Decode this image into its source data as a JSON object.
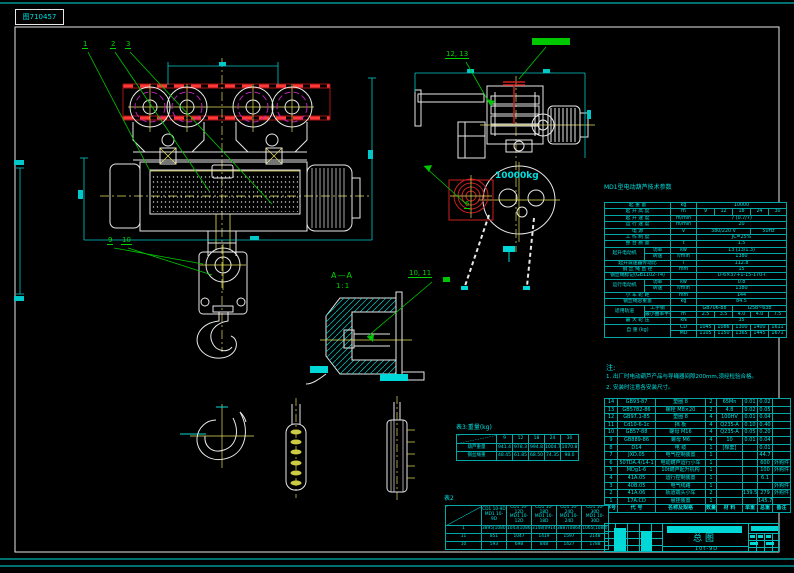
{
  "stamp": {
    "text": "图710457"
  },
  "annotations": {
    "c1": "1",
    "c2": "2",
    "c3": "3",
    "c6": "6",
    "c9": "9",
    "c10": "10",
    "c10_11": "10, 11",
    "c12_13": "12, 13",
    "section": "A—A",
    "scale": "1:1",
    "load": "10000kg"
  },
  "spec_table": {
    "title": "MD1型电动葫芦技术参数",
    "colw": [
      40,
      26,
      26,
      18,
      18,
      18,
      18,
      18
    ],
    "rows": [
      [
        {
          "t": "起 重 量",
          "c": 2
        },
        {
          "t": "kg"
        },
        {
          "t": "10000",
          "c": 5
        }
      ],
      [
        {
          "t": "起 升 高 度",
          "c": 2
        },
        {
          "t": "m"
        },
        {
          "t": "9"
        },
        {
          "t": "12"
        },
        {
          "t": "18"
        },
        {
          "t": "24"
        },
        {
          "t": "30"
        }
      ],
      [
        {
          "t": "起 升 速 度",
          "c": 2
        },
        {
          "t": "m/min"
        },
        {
          "t": "7 (0.7/7)",
          "c": 5
        }
      ],
      [
        {
          "t": "运 行 速 度",
          "c": 2
        },
        {
          "t": "m/min"
        },
        {
          "t": "20",
          "c": 5
        }
      ],
      [
        {
          "t": "电  源",
          "c": 2
        },
        {
          "t": "V"
        },
        {
          "t": "380/220 V",
          "c": 3
        },
        {
          "t": "50Hz",
          "c": 2
        }
      ],
      [
        {
          "t": "工 作 制 度",
          "c": 2
        },
        {
          "t": ""
        },
        {
          "t": "JC=25%",
          "c": 5
        }
      ],
      [
        {
          "t": "整 台 质 量",
          "c": 2
        },
        {
          "t": "t"
        },
        {
          "t": "1.5",
          "c": 5
        }
      ],
      [
        {
          "t": "起升电动机",
          "r": 2
        },
        {
          "t": "功率"
        },
        {
          "t": "kw"
        },
        {
          "t": "13 (13/1.3)",
          "c": 5
        }
      ],
      [
        {
          "t": "转速"
        },
        {
          "t": "r/min"
        },
        {
          "t": "1380",
          "c": 5
        }
      ],
      [
        {
          "t": "起升减速器传动比",
          "c": 2
        },
        {
          "t": "i"
        },
        {
          "t": "112.8",
          "c": 5
        }
      ],
      [
        {
          "t": "钢 丝 绳 直 径",
          "c": 2
        },
        {
          "t": "mm"
        },
        {
          "t": "15",
          "c": 5
        }
      ],
      [
        {
          "t": "钢丝绳标记(GB1102-74)",
          "c": 2
        },
        {
          "t": ""
        },
        {
          "t": "D-6×37+1-15-170-I",
          "c": 5
        }
      ],
      [
        {
          "t": "运行电动机",
          "r": 2
        },
        {
          "t": "功率"
        },
        {
          "t": "kw"
        },
        {
          "t": "0.8",
          "c": 5
        }
      ],
      [
        {
          "t": "转速"
        },
        {
          "t": "r/min"
        },
        {
          "t": "1380",
          "c": 5
        }
      ],
      [
        {
          "t": "小 车 轮 距",
          "c": 2
        },
        {
          "t": "mm"
        },
        {
          "t": "144",
          "c": 5
        }
      ],
      [
        {
          "t": "钢丝绳总重量",
          "c": 2
        },
        {
          "t": "kg"
        },
        {
          "t": "84.5",
          "c": 5
        }
      ],
      [
        {
          "t": "适用轨道",
          "r": 2
        },
        {
          "t": "工字钢"
        },
        {
          "t": ""
        },
        {
          "t": "GB706-88",
          "c": 2
        },
        {
          "t": "I25b~63b",
          "c": 3
        }
      ],
      [
        {
          "t": "最小曲率半径"
        },
        {
          "t": "m"
        },
        {
          "t": "2.5"
        },
        {
          "t": "3.5"
        },
        {
          "t": "4.0"
        },
        {
          "t": "4.0"
        },
        {
          "t": "7.5"
        }
      ],
      [
        {
          "t": "最 大 轮 压",
          "c": 2
        },
        {
          "t": "kN"
        },
        {
          "t": "35",
          "c": 5
        }
      ],
      [
        {
          "t": "自 重 (kg)",
          "c": 2,
          "r": 2
        },
        {
          "t": "CD"
        },
        {
          "t": "1045"
        },
        {
          "t": "1086"
        },
        {
          "t": "1300"
        },
        {
          "t": "1400"
        },
        {
          "t": "1611"
        }
      ],
      [
        {
          "t": "MD"
        },
        {
          "t": "1105"
        },
        {
          "t": "1150"
        },
        {
          "t": "1365"
        },
        {
          "t": "1445"
        },
        {
          "t": "1671"
        }
      ]
    ]
  },
  "notes": {
    "heading": "注:",
    "line1": "1. 出厂时电动葫芦产品与导绳器间隙200mm,须经检验合格。",
    "line2": "2. 安装时注意各安装尺寸。"
  },
  "bom_table": {
    "colw": [
      13,
      38,
      50,
      11,
      26,
      15,
      15,
      18
    ],
    "rows": [
      [
        {
          "t": "14"
        },
        {
          "t": "GB93-87"
        },
        {
          "t": "垫圈 8"
        },
        {
          "t": "2"
        },
        {
          "t": "65Mn"
        },
        {
          "t": "0.01"
        },
        {
          "t": "0.02"
        },
        {
          "t": ""
        }
      ],
      [
        {
          "t": "13"
        },
        {
          "t": "GB5782-86"
        },
        {
          "t": "螺栓 M8×20"
        },
        {
          "t": "2"
        },
        {
          "t": "4.8"
        },
        {
          "t": "0.02"
        },
        {
          "t": "0.05"
        },
        {
          "t": ""
        }
      ],
      [
        {
          "t": "12"
        },
        {
          "t": "GB97.1-85"
        },
        {
          "t": "垫圈 8"
        },
        {
          "t": "4"
        },
        {
          "t": "100HV"
        },
        {
          "t": "0.01"
        },
        {
          "t": "0.04"
        },
        {
          "t": ""
        }
      ],
      [
        {
          "t": "11"
        },
        {
          "t": "Cd10-6-1c"
        },
        {
          "t": "挡 板"
        },
        {
          "t": "4"
        },
        {
          "t": "Q235-A"
        },
        {
          "t": "0.10"
        },
        {
          "t": "0.40"
        },
        {
          "t": ""
        }
      ],
      [
        {
          "t": "10"
        },
        {
          "t": "GB57-88"
        },
        {
          "t": "螺母 M16"
        },
        {
          "t": "4"
        },
        {
          "t": "Q235-A"
        },
        {
          "t": "0.05"
        },
        {
          "t": "0.20"
        },
        {
          "t": ""
        }
      ],
      [
        {
          "t": "9"
        },
        {
          "t": "GB889-86"
        },
        {
          "t": "螺母 M6"
        },
        {
          "t": "4"
        },
        {
          "t": "10"
        },
        {
          "t": "0.01"
        },
        {
          "t": "0.04"
        },
        {
          "t": ""
        }
      ],
      [
        {
          "t": "8"
        },
        {
          "t": "D14"
        },
        {
          "t": "电 缆"
        },
        {
          "t": "1"
        },
        {
          "t": "[橡套]"
        },
        {
          "t": ""
        },
        {
          "t": "0.01"
        },
        {
          "t": ""
        }
      ],
      [
        {
          "t": "7"
        },
        {
          "t": "JXD.05"
        },
        {
          "t": "电气控制装置"
        },
        {
          "t": "1"
        },
        {
          "t": ""
        },
        {
          "t": ""
        },
        {
          "t": "44.7"
        },
        {
          "t": ""
        }
      ],
      [
        {
          "t": "6"
        },
        {
          "t": "50TDA.4/14-1"
        },
        {
          "t": "电动葫芦运行小车"
        },
        {
          "t": "1"
        },
        {
          "t": ""
        },
        {
          "t": ""
        },
        {
          "t": "600"
        },
        {
          "t": "外购件"
        }
      ],
      [
        {
          "t": "5"
        },
        {
          "t": "MDg1-6"
        },
        {
          "t": "10t葫芦起升机构"
        },
        {
          "t": "1"
        },
        {
          "t": ""
        },
        {
          "t": ""
        },
        {
          "t": "100"
        },
        {
          "t": "外购件"
        }
      ],
      [
        {
          "t": "4"
        },
        {
          "t": "41A.05"
        },
        {
          "t": "运行控制装置"
        },
        {
          "t": "1"
        },
        {
          "t": ""
        },
        {
          "t": ""
        },
        {
          "t": "6.1"
        },
        {
          "t": ""
        }
      ],
      [
        {
          "t": "3"
        },
        {
          "t": "40B.05"
        },
        {
          "t": "电气线路"
        },
        {
          "t": "1"
        },
        {
          "t": ""
        },
        {
          "t": ""
        },
        {
          "t": ""
        },
        {
          "t": "外购件"
        }
      ],
      [
        {
          "t": "2"
        },
        {
          "t": "41A.06"
        },
        {
          "t": "轨道端头小车"
        },
        {
          "t": "2"
        },
        {
          "t": ""
        },
        {
          "t": "139.5"
        },
        {
          "t": "279"
        },
        {
          "t": "外购件"
        }
      ],
      [
        {
          "t": "1"
        },
        {
          "t": "17A.CD"
        },
        {
          "t": "悬挂装置"
        },
        {
          "t": "1"
        },
        {
          "t": ""
        },
        {
          "t": ""
        },
        {
          "t": "145.7"
        },
        {
          "t": ""
        }
      ],
      [
        {
          "t": "序号"
        },
        {
          "t": "代 号"
        },
        {
          "t": "名称及规格"
        },
        {
          "t": "数量"
        },
        {
          "t": "材 料"
        },
        {
          "t": "单重"
        },
        {
          "t": "总重"
        },
        {
          "t": "备注"
        }
      ]
    ]
  },
  "weight_table": {
    "caption": "表3:重量(kg)",
    "corner_top": "起升高度(m)",
    "corner_bottom": "名 称",
    "colw": [
      40,
      16,
      16,
      16,
      16,
      18
    ],
    "rows": [
      [
        {
          "t": "",
          "cls": "diag"
        },
        {
          "t": "9"
        },
        {
          "t": "12"
        },
        {
          "t": "18"
        },
        {
          "t": "24"
        },
        {
          "t": "30"
        }
      ],
      [
        {
          "t": "葫芦重量"
        },
        {
          "t": "941.4"
        },
        {
          "t": "978.3"
        },
        {
          "t": "994.8"
        },
        {
          "t": "1004.7"
        },
        {
          "t": "1070.8"
        }
      ],
      [
        {
          "t": "钢丝绳重"
        },
        {
          "t": "48.45"
        },
        {
          "t": "61.85"
        },
        {
          "t": "68.50"
        },
        {
          "t": "74.35"
        },
        {
          "t": "98.0"
        }
      ]
    ]
  },
  "model_table": {
    "caption": "表2",
    "corner_top": "型 号",
    "corner_bottom": "件 号",
    "colw": [
      36,
      25,
      25,
      25,
      25,
      27
    ],
    "rows": [
      [
        {
          "t": "",
          "cls": "diag"
        },
        {
          "t": "CD1 10-9D\nMD1 10-9D"
        },
        {
          "t": "CD1 10-12D\nMD1 10-12D"
        },
        {
          "t": "CD1 10-18D\nMD1 10-18D"
        },
        {
          "t": "CD1 10-24D\nMD1 10-24D"
        },
        {
          "t": "CD1 10-30D\nMD1 10-30D"
        }
      ],
      [
        {
          "t": "1"
        },
        {
          "t": "3895(1080)"
        },
        {
          "t": "1043(1086)"
        },
        {
          "t": "3148(0914)"
        },
        {
          "t": "3887(0864)"
        },
        {
          "t": "1065(1088)"
        }
      ],
      [
        {
          "t": "11"
        },
        {
          "t": "851"
        },
        {
          "t": "1047"
        },
        {
          "t": "1419"
        },
        {
          "t": "1597"
        },
        {
          "t": "2148"
        }
      ],
      [
        {
          "t": "10"
        },
        {
          "t": "593"
        },
        {
          "t": "698"
        },
        {
          "t": "848"
        },
        {
          "t": "1427"
        },
        {
          "t": "1788"
        }
      ]
    ]
  },
  "title_block": {
    "title": "总图",
    "model": "10t-9D"
  }
}
